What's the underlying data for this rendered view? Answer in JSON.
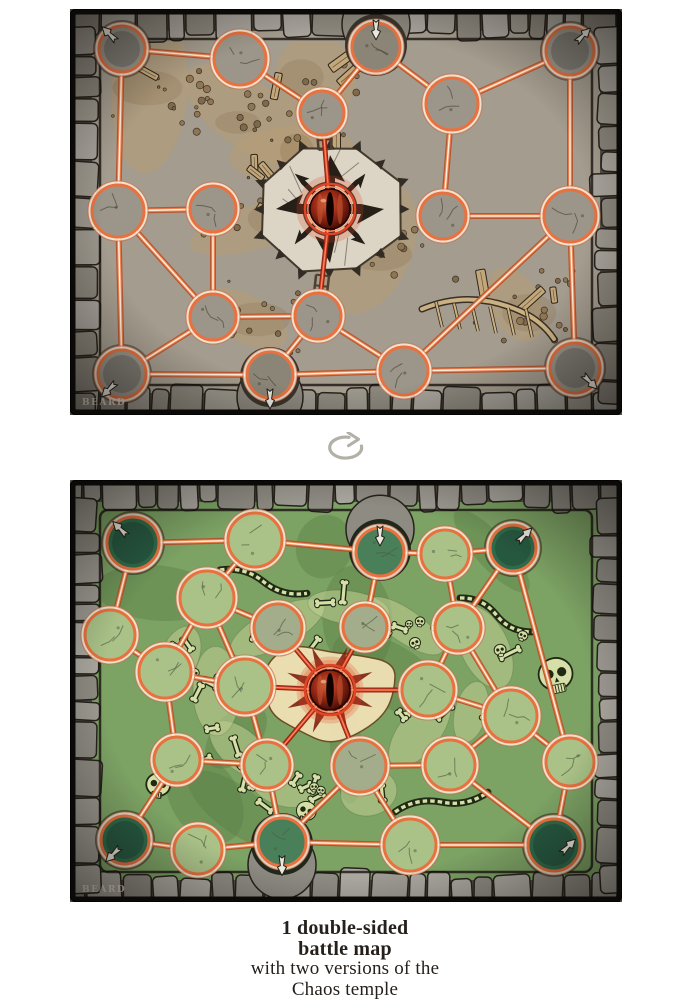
{
  "caption": {
    "line1": "1 double-sided",
    "line2": "battle map",
    "line3": "with two versions of the",
    "line4": "Chaos temple"
  },
  "rotate_icon": {
    "name": "flip-rotate-icon",
    "color": "#b3b0a8"
  },
  "top_map": {
    "variant": "dungeon",
    "signature": "BEARD",
    "width": 552,
    "height": 406,
    "eye": {
      "x": 260,
      "y": 200,
      "r": 20
    },
    "ladders": [
      2,
      11
    ],
    "palette": {
      "stoneBase": "#524e46",
      "stoneA": "#9a968c",
      "stoneB": "#8a867c",
      "stoneC": "#a7a39b",
      "stoneLine": "#27221b",
      "floor": "#a49c8e",
      "patch": "#b79c72",
      "patch2": "#8d7452",
      "debris": "#7c6748",
      "debrisLine": "#2e2418",
      "plank": "#c2a77a",
      "bone": "#d6dfa8",
      "platform": "#dcd5c5",
      "platformLine": "#433a2e",
      "star": "#261f18",
      "spike": "#332c24",
      "nodeFill": "#9c968a",
      "nodeFill2": "#a39b8a",
      "cornerFill": "#9c968a",
      "gateFill": "#8b8577",
      "alcove": "#39342b",
      "crack": "#4b443a",
      "ring": "#e8713f",
      "lineOuter": "#b5502b",
      "line": "#ef8551",
      "lineCore": "#ffeedb",
      "redOuter": "#8e1f10",
      "red": "#e04526",
      "redCore": "#ff9468",
      "eye_hi": "#d2643c",
      "eye_mid": "#9c2a16",
      "eye_dark": "#380905",
      "arrow": "#ebe8df",
      "signatureColor": "#e6e0d2"
    },
    "nodes": [
      {
        "x": 52,
        "y": 40,
        "r": 23,
        "kind": "corner",
        "arrow": "nw",
        "ax": -0.5,
        "ay": -0.6
      },
      {
        "x": 170,
        "y": 50,
        "r": 26
      },
      {
        "x": 252,
        "y": 104,
        "r": 22
      },
      {
        "x": 306,
        "y": 38,
        "r": 24,
        "kind": "gate",
        "arrow": "s",
        "ax": 0,
        "ay": -0.8
      },
      {
        "x": 382,
        "y": 95,
        "r": 26
      },
      {
        "x": 500,
        "y": 42,
        "r": 24,
        "kind": "corner",
        "arrow": "ne",
        "ax": 0.5,
        "ay": -0.6
      },
      {
        "x": 48,
        "y": 202,
        "r": 26
      },
      {
        "x": 143,
        "y": 200,
        "r": 23
      },
      {
        "x": 373,
        "y": 207,
        "r": 23
      },
      {
        "x": 500,
        "y": 207,
        "r": 26
      },
      {
        "x": 143,
        "y": 308,
        "r": 23
      },
      {
        "x": 248,
        "y": 307,
        "r": 23
      },
      {
        "x": 52,
        "y": 365,
        "r": 24,
        "kind": "corner",
        "arrow": "sw",
        "ax": -0.5,
        "ay": 0.6
      },
      {
        "x": 200,
        "y": 366,
        "r": 23,
        "kind": "gate",
        "arrow": "s",
        "ax": 0,
        "ay": 0.95
      },
      {
        "x": 334,
        "y": 362,
        "r": 24
      },
      {
        "x": 505,
        "y": 359,
        "r": 25,
        "kind": "corner",
        "arrow": "se",
        "ax": 0.55,
        "ay": 0.5
      }
    ],
    "edges": [
      [
        0,
        1
      ],
      [
        1,
        2
      ],
      [
        2,
        3
      ],
      [
        3,
        4
      ],
      [
        4,
        5
      ],
      [
        0,
        6
      ],
      [
        6,
        7
      ],
      [
        4,
        8
      ],
      [
        5,
        9
      ],
      [
        8,
        9
      ],
      [
        6,
        10
      ],
      [
        7,
        10
      ],
      [
        10,
        11
      ],
      [
        10,
        12
      ],
      [
        6,
        12
      ],
      [
        11,
        13
      ],
      [
        11,
        14
      ],
      [
        12,
        13
      ],
      [
        13,
        14
      ],
      [
        14,
        15
      ],
      [
        9,
        14
      ],
      [
        9,
        15
      ]
    ],
    "red_edges": [
      [
        "eye",
        2
      ],
      [
        "eye",
        11
      ]
    ]
  },
  "bottom_map": {
    "variant": "ossuary",
    "signature": "BEARD",
    "width": 552,
    "height": 422,
    "eye": {
      "x": 260,
      "y": 210,
      "r": 20
    },
    "palette": {
      "stoneBase": "#514e47",
      "stoneA": "#9d9a92",
      "stoneB": "#8e8b83",
      "stoneC": "#aaa79f",
      "stoneLine": "#26221c",
      "floor": "#7ca264",
      "patch": "#587f45",
      "patch2": "#49703c",
      "debris": "#5c8a49",
      "debrisLine": "#1f2913",
      "plank": "#c2a77a",
      "bonesBg": "#c2cf93",
      "bone": "#d6dfa8",
      "platform": "#eedfb3",
      "platformTint": "#e2a06c",
      "star": "#7e2012",
      "nodeFill": "#aac288",
      "nodeFill2": "#a3ad8c",
      "cornerFill": "#2f6b4a",
      "gateFill": "#4a8059",
      "alcove": "#20281c",
      "crack": "#4e5c42",
      "ring": "#e8713f",
      "lineOuter": "#b5502b",
      "line": "#ef8551",
      "lineCore": "#ffeedb",
      "redOuter": "#8e1f10",
      "red": "#e04526",
      "redCore": "#ff9468",
      "eye_hi": "#d2643c",
      "eye_mid": "#9c2a16",
      "eye_dark": "#380905",
      "arrow": "#ebe8df",
      "signatureColor": "#e6e0d2"
    },
    "nodes": [
      {
        "x": 63,
        "y": 63,
        "r": 26,
        "kind": "corner",
        "arrow": "nw",
        "ax": -0.45,
        "ay": -0.5
      },
      {
        "x": 185,
        "y": 60,
        "r": 27
      },
      {
        "x": 310,
        "y": 72,
        "r": 24,
        "kind": "gate",
        "arrow": "s",
        "ax": 0,
        "ay": -0.75
      },
      {
        "x": 375,
        "y": 74,
        "r": 24
      },
      {
        "x": 443,
        "y": 68,
        "r": 23,
        "kind": "corner",
        "arrow": "ne",
        "ax": 0.45,
        "ay": -0.5
      },
      {
        "x": 40,
        "y": 155,
        "r": 25
      },
      {
        "x": 137,
        "y": 118,
        "r": 27
      },
      {
        "x": 208,
        "y": 148,
        "r": 24,
        "v": 1
      },
      {
        "x": 295,
        "y": 147,
        "r": 22,
        "v": 1
      },
      {
        "x": 388,
        "y": 148,
        "r": 23
      },
      {
        "x": 95,
        "y": 192,
        "r": 26
      },
      {
        "x": 175,
        "y": 206,
        "r": 27
      },
      {
        "x": 358,
        "y": 210,
        "r": 26
      },
      {
        "x": 441,
        "y": 236,
        "r": 26
      },
      {
        "x": 500,
        "y": 282,
        "r": 24
      },
      {
        "x": 107,
        "y": 280,
        "r": 23
      },
      {
        "x": 197,
        "y": 285,
        "r": 23
      },
      {
        "x": 290,
        "y": 286,
        "r": 26,
        "v": 1
      },
      {
        "x": 380,
        "y": 285,
        "r": 25
      },
      {
        "x": 55,
        "y": 360,
        "r": 24,
        "kind": "corner",
        "arrow": "sw",
        "ax": -0.45,
        "ay": 0.55
      },
      {
        "x": 128,
        "y": 370,
        "r": 24
      },
      {
        "x": 212,
        "y": 362,
        "r": 24,
        "kind": "gate",
        "arrow": "s",
        "ax": 0,
        "ay": 0.9
      },
      {
        "x": 340,
        "y": 365,
        "r": 26
      },
      {
        "x": 484,
        "y": 365,
        "r": 26,
        "kind": "corner",
        "arrow": "ne",
        "ax": 0.5,
        "ay": 0.1
      }
    ],
    "edges": [
      [
        0,
        1
      ],
      [
        1,
        2
      ],
      [
        2,
        3
      ],
      [
        3,
        4
      ],
      [
        0,
        5
      ],
      [
        1,
        6
      ],
      [
        2,
        8
      ],
      [
        3,
        9
      ],
      [
        4,
        9
      ],
      [
        4,
        14
      ],
      [
        5,
        10
      ],
      [
        6,
        7
      ],
      [
        6,
        10
      ],
      [
        6,
        11
      ],
      [
        9,
        12
      ],
      [
        9,
        13
      ],
      [
        10,
        11
      ],
      [
        10,
        15
      ],
      [
        12,
        13
      ],
      [
        13,
        14
      ],
      [
        13,
        18
      ],
      [
        14,
        23
      ],
      [
        15,
        16
      ],
      [
        15,
        19
      ],
      [
        16,
        21
      ],
      [
        17,
        21
      ],
      [
        17,
        18
      ],
      [
        18,
        23
      ],
      [
        19,
        20
      ],
      [
        20,
        21
      ],
      [
        21,
        22
      ],
      [
        22,
        23
      ],
      [
        11,
        16
      ],
      [
        17,
        22
      ]
    ],
    "red_edges": [
      [
        "eye",
        7
      ],
      [
        "eye",
        8
      ],
      [
        "eye",
        11
      ],
      [
        "eye",
        12
      ],
      [
        "eye",
        16
      ],
      [
        "eye",
        17
      ]
    ]
  }
}
